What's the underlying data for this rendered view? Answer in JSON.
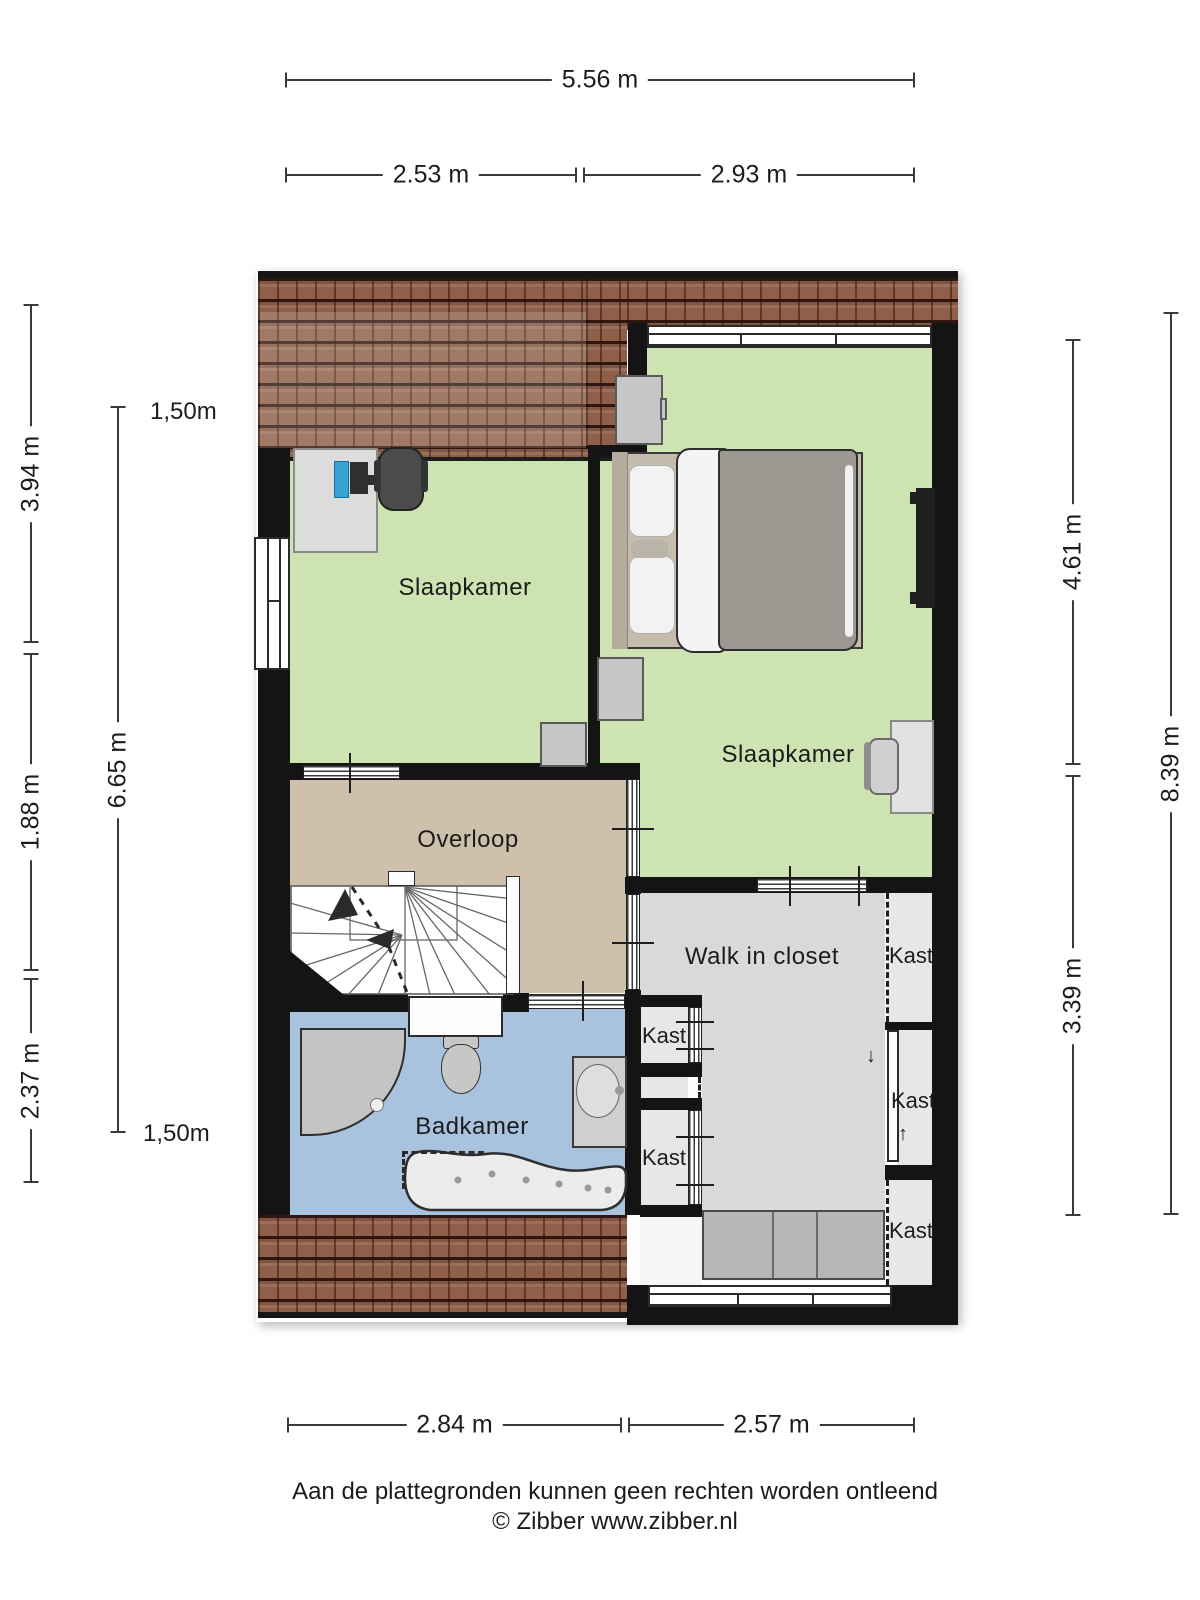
{
  "rooms": {
    "bedroom_left": "Slaapkamer",
    "bedroom_right": "Slaapkamer",
    "landing": "Overloop",
    "bathroom": "Badkamer",
    "walk_in_closet": "Walk in closet"
  },
  "closets": {
    "left_top": "Kast",
    "left_bottom": "Kast",
    "right_top": "Kast",
    "right_middle": "Kast",
    "right_bottom": "Kast"
  },
  "dimensions": {
    "top_total": "5.56 m",
    "top_left": "2.53 m",
    "top_right": "2.93 m",
    "bottom_left": "2.84 m",
    "bottom_right": "2.57 m",
    "left_upper": "3.94 m",
    "left_middle": "1.88 m",
    "left_lower": "2.37 m",
    "left_inner": "6.65 m",
    "right_inner_upper": "4.61 m",
    "right_inner_lower": "3.39 m",
    "right_outer": "8.39 m",
    "height_marker_top": "1,50m",
    "height_marker_bottom": "1,50m"
  },
  "arrows": {
    "down": "↓",
    "up": "↑"
  },
  "footer": {
    "disclaimer": "Aan de plattegronden kunnen geen rechten worden ontleend",
    "copyright": "© Zibber www.zibber.nl"
  },
  "colors": {
    "wall": "#141414",
    "floor_bedroom": "#cde3b1",
    "floor_landing": "#cec0aa",
    "floor_bathroom": "#a9c2de",
    "floor_closet": "#d9d9d9",
    "roof_tiles": "#8f5f49",
    "dimension_line": "#3a3a3a"
  }
}
